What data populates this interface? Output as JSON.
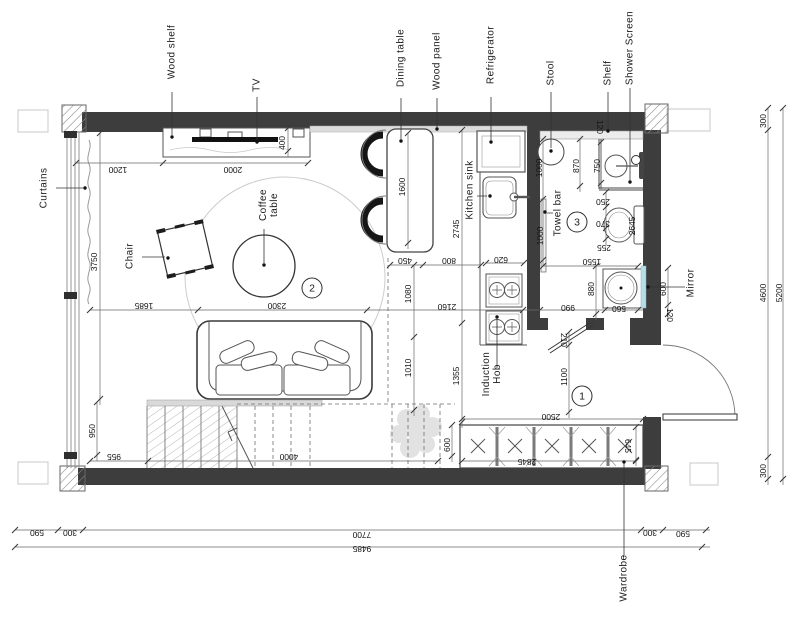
{
  "drawing_type": "apartment floor plan",
  "colors": {
    "wall": "#3d3d3d",
    "mirror_accent": "#b9dde6",
    "line": "#4a4a4a",
    "paper": "#ffffff",
    "rug": "#cccccc"
  },
  "labels": {
    "wood_shelf": "Wood shelf",
    "tv": "TV",
    "dining_table": "Dining table",
    "wood_panel": "Wood panel",
    "refrigerator": "Refrigerator",
    "stool": "Stool",
    "shelf": "Shelf",
    "shower_screen": "Shower Screen",
    "curtains": "Curtains",
    "chair": "Chair",
    "coffee_table_line1": "Coffee",
    "coffee_table_line2": "table",
    "kitchen_sink": "Kitchen sink",
    "towel_bar": "Towel bar",
    "induction_hob_line1": "Induction",
    "induction_hob_line2": "Hob",
    "mirror": "Mirror",
    "wardrobe": "Wardrobe"
  },
  "zone_markers": {
    "hall": "1",
    "living": "2",
    "bathroom": "3"
  },
  "dimensions": {
    "top": {
      "d1200": "1200",
      "d2000": "2000",
      "d400": "400"
    },
    "left": {
      "d3750": "3750",
      "d1685": "1685",
      "d950": "950",
      "d955": "955",
      "d4000": "4000"
    },
    "living": {
      "d2300": "2300"
    },
    "kitchen": {
      "d1600": "1600",
      "d2745": "2745",
      "d450": "450",
      "d800": "800",
      "d1080": "1080",
      "d2160": "2160",
      "d1010": "1010",
      "d1355": "1355",
      "d620": "620"
    },
    "bathroom": {
      "d1000_stool": "1000",
      "d870": "870",
      "d750": "750",
      "d120_shelf": "120",
      "d250": "250",
      "d370": "370",
      "d255": "255",
      "d2645": "2645",
      "d1000_towel": "1000",
      "d1550": "1550",
      "d880": "880",
      "d990": "990",
      "d560": "560"
    },
    "mirror": {
      "d600": "600",
      "d120": "120"
    },
    "hall": {
      "d210": "210",
      "d1100": "1100",
      "d2500": "2500"
    },
    "wardrobe": {
      "d600": "600",
      "d2845": "2845",
      "d645": "645"
    },
    "bottom": {
      "d590_left": "590",
      "d300_left": "300",
      "d7700": "7700",
      "d300_right": "300",
      "d590_right": "590",
      "d9485": "9485"
    },
    "right": {
      "d300_top": "300",
      "d4600": "4600",
      "d300_bottom": "300",
      "d5200": "5200"
    }
  }
}
